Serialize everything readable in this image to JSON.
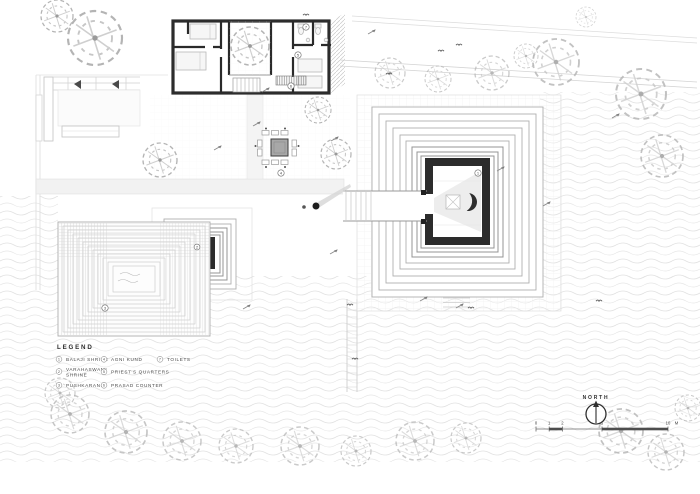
{
  "legend": {
    "title": "LEGEND",
    "items": [
      {
        "num": "1",
        "label": "BALAJI SHRINE"
      },
      {
        "num": "2",
        "label": "VARAHASWAMI SHRINE",
        "lines": [
          "VARAHASWAMI",
          "SHRINE"
        ]
      },
      {
        "num": "3",
        "label": "PUSHKARANI"
      },
      {
        "num": "4",
        "label": "AGNI KUND"
      },
      {
        "num": "5",
        "label": "PRIEST'S QUARTERS"
      },
      {
        "num": "6",
        "label": "PRASAD COUNTER"
      },
      {
        "num": "7",
        "label": "TOILETS"
      }
    ]
  },
  "compass": {
    "label": "NORTH"
  },
  "scalebar": {
    "ticks": [
      "0",
      "1",
      "2",
      "5",
      "10"
    ],
    "unit": "M"
  },
  "colors": {
    "wall_ink": "#2c2c2c",
    "line_grey": "#c4c4c4",
    "water_grey": "#dedede",
    "text_grey": "#3f3f3f"
  }
}
